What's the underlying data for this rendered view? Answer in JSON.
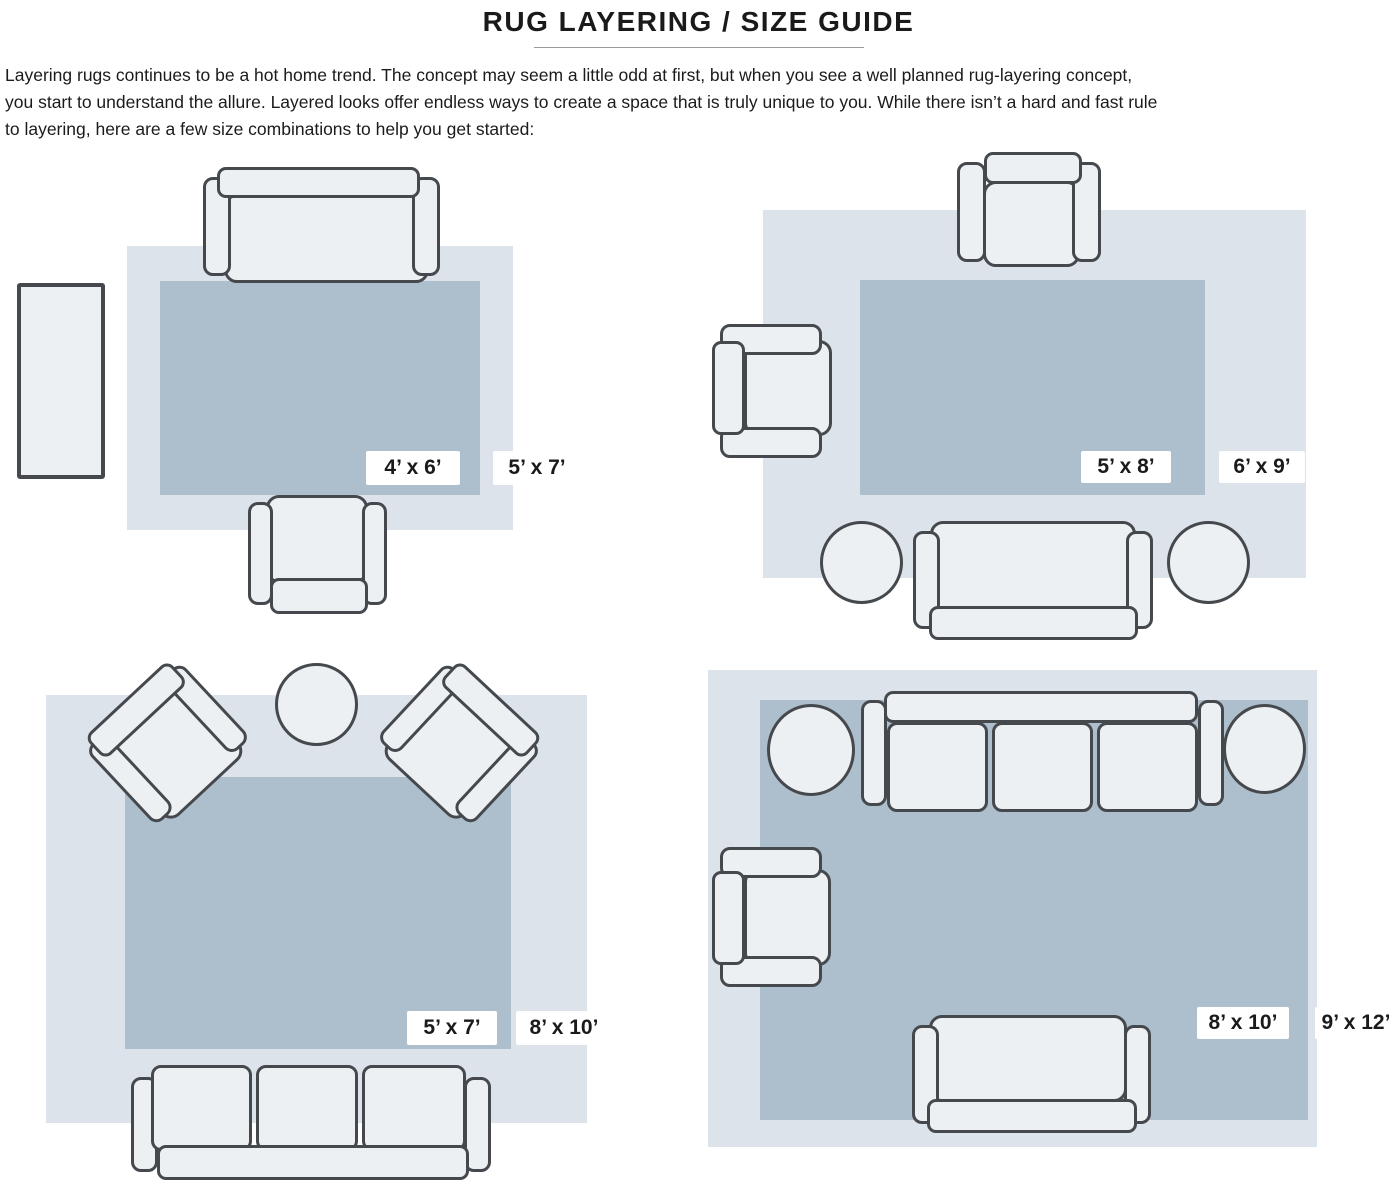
{
  "page": {
    "title": "RUG LAYERING / SIZE GUIDE",
    "intro_lines": [
      "Layering rugs continues to be a hot home trend. The concept may seem a little odd at first, but when you see a well planned rug-layering concept,",
      "you start to understand the allure. Layered looks offer endless ways to create a space that is truly unique to you. While there isn’t a hard and fast rule",
      "to layering, here are a few size combinations to help you get started:"
    ]
  },
  "colors": {
    "rug_light": "#dde3ea",
    "rug_dark": "#adbfcc",
    "furniture_fill": "#edf0f3",
    "furniture_outline": "#45494e",
    "label_bg": "#ffffff",
    "label_text": "#1a1a1a"
  },
  "diagrams": [
    {
      "name": "sofa-armchair-runner",
      "inner_label": "4’ x 6’",
      "outer_label": "5’ x 7’"
    },
    {
      "name": "two-chairs-sofa-poufs",
      "inner_label": "5’ x 8’",
      "outer_label": "6’ x 9’"
    },
    {
      "name": "angled-chairs-table-sofa",
      "inner_label": "5’ x 7’",
      "outer_label": "8’ x 10’"
    },
    {
      "name": "sofa-loveseat-chair-poufs",
      "inner_label": "8’ x 10’",
      "outer_label": "9’ x 12’"
    }
  ]
}
